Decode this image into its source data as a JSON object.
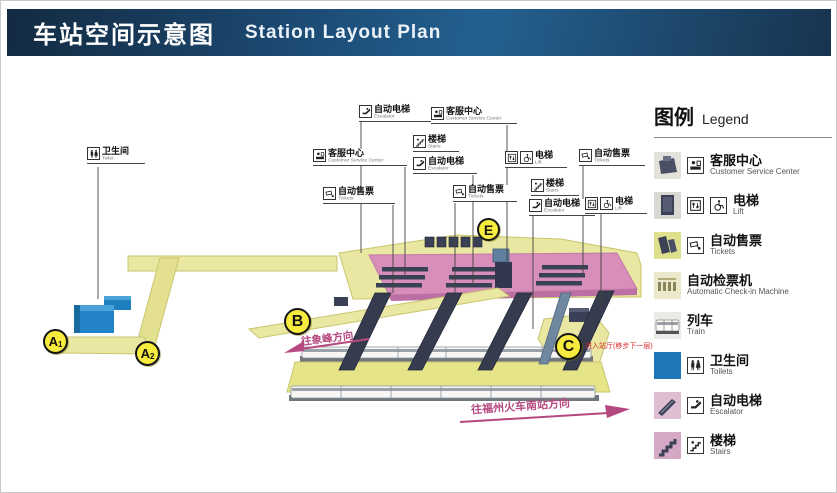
{
  "header": {
    "title_zh": "车站空间示意图",
    "title_en": "Station Layout Plan"
  },
  "legend": {
    "title_zh": "图例",
    "title_en": "Legend",
    "items": [
      {
        "zh": "客服中心",
        "en": "Customer Service Center"
      },
      {
        "zh": "电梯",
        "en": "Lift"
      },
      {
        "zh": "自动售票",
        "en": "Tickets"
      },
      {
        "zh": "自动检票机",
        "en": "Automatic Check-in Machine"
      },
      {
        "zh": "列车",
        "en": "Train"
      },
      {
        "zh": "卫生间",
        "en": "Toilets"
      },
      {
        "zh": "自动电梯",
        "en": "Escalator"
      },
      {
        "zh": "楼梯",
        "en": "Stairs"
      }
    ]
  },
  "callouts": [
    {
      "zh": "卫生间",
      "en": "Toilet"
    },
    {
      "zh": "客服中心",
      "en": "Customer Service Center"
    },
    {
      "zh": "自动售票",
      "en": "Tickets"
    },
    {
      "zh": "自动电梯",
      "en": "Escalator"
    },
    {
      "zh": "客服中心",
      "en": "Customer Service Center"
    },
    {
      "zh": "楼梯",
      "en": "Stairs"
    },
    {
      "zh": "自动电梯",
      "en": "Escalator"
    },
    {
      "zh": "自动售票",
      "en": "Tickets"
    },
    {
      "zh": "电梯",
      "en": "Lift"
    },
    {
      "zh": "自动售票",
      "en": "Tickets"
    },
    {
      "zh": "楼梯",
      "en": "Stairs"
    },
    {
      "zh": "自动电梯",
      "en": "Escalator"
    },
    {
      "zh": "电梯",
      "en": "Lift"
    }
  ],
  "markers": [
    {
      "label": "A",
      "sub": "1"
    },
    {
      "label": "A",
      "sub": "2"
    },
    {
      "label": "B",
      "sub": ""
    },
    {
      "label": "C",
      "sub": ""
    },
    {
      "label": "E",
      "sub": ""
    }
  ],
  "arrows": {
    "to_xiangfeng": "往象峰方向",
    "to_fuzhou_south": "往福州火车南站方向"
  },
  "notes": {
    "enter_hall": "进入站厅(移步下一层)"
  },
  "colors": {
    "header_blue": "#1d4d77",
    "walkway_yellow": "#e9e7a2",
    "concourse_pink": "#d78fba",
    "marker_yellow": "#f7ec3e",
    "toilet_blue": "#1f7ec0",
    "equipment_navy": "#3a4055",
    "arrow_pink": "#b5497f"
  }
}
